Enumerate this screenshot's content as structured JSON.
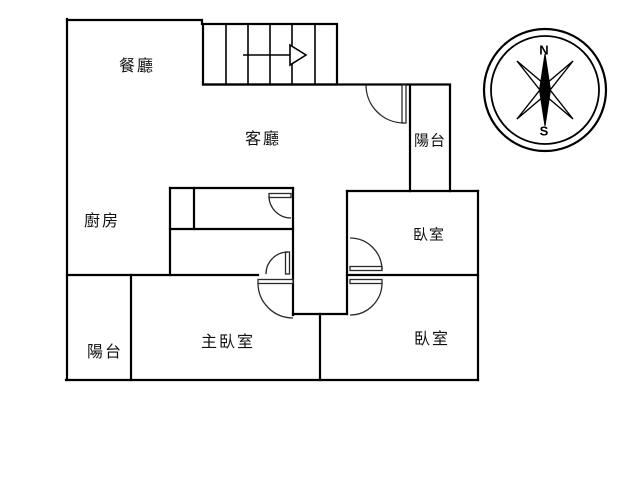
{
  "page": {
    "background_color": "#ffffff",
    "line_color": "#000000"
  },
  "rooms": {
    "dining": {
      "label": "餐廳"
    },
    "living": {
      "label": "客廳"
    },
    "kitchen": {
      "label": "廚房"
    },
    "balcony_upper": {
      "label": "陽台"
    },
    "balcony_lower": {
      "label": "陽台"
    },
    "bedroom_upper": {
      "label": "臥室"
    },
    "bedroom_lower": {
      "label": "臥室"
    },
    "master_bedroom": {
      "label": "主臥室"
    }
  },
  "compass": {
    "north_label": "N",
    "south_label": "S"
  }
}
